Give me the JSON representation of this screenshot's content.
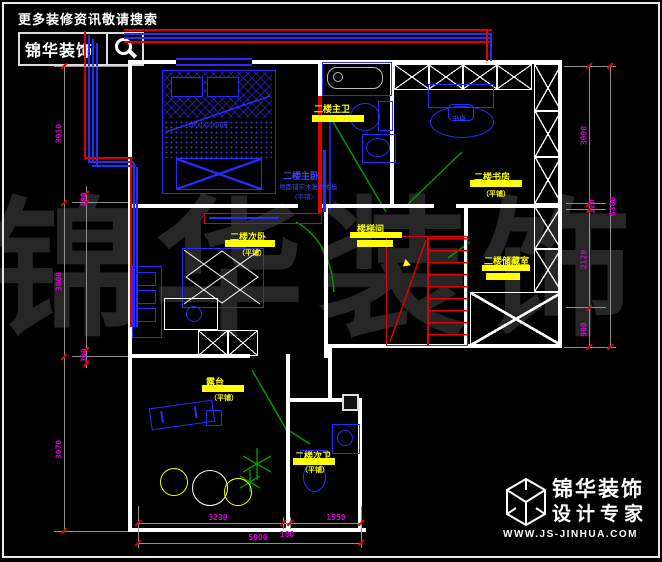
{
  "header": {
    "tagline": "更多装修资讯敬请搜索",
    "brand": "锦华装饰",
    "search_icon": "magnifier"
  },
  "watermark": "锦华装饰",
  "rooms": [
    {
      "name": "master-bedroom",
      "label": "二楼主卧",
      "note": "地面铺实木复合地板",
      "finish": "（平铺）"
    },
    {
      "name": "master-bath",
      "label": "二楼主卫",
      "finish": ""
    },
    {
      "name": "study",
      "label": "二楼书房",
      "finish": "（平铺）"
    },
    {
      "name": "second-bedroom",
      "label": "二楼次卧",
      "finish": "（平铺）"
    },
    {
      "name": "stairwell",
      "label": "楼梯间",
      "finish": ""
    },
    {
      "name": "storage",
      "label": "二楼储藏室",
      "finish": ""
    },
    {
      "name": "terrace",
      "label": "露台",
      "finish": "（平铺）"
    },
    {
      "name": "second-bath",
      "label": "二楼次卫",
      "finish": "（平铺）"
    }
  ],
  "annotations": {
    "bed": "1800X2000床",
    "desk": "书桌"
  },
  "dimensions": {
    "left_outer": [
      "3010",
      "3000",
      "3070"
    ],
    "left_inner": [
      "180",
      "300"
    ],
    "right_inner": [
      "3090",
      "2120",
      "900"
    ],
    "right_step": "120",
    "right_outer": "6300",
    "bottom_top_row": [
      "3230",
      "180",
      "1550"
    ],
    "bottom_total": "5000"
  },
  "brandmark": {
    "brand": "锦华装饰",
    "tagline": "设计专家",
    "url": "WWW.JS-JINHUA.COM",
    "logo": "cube-logo"
  },
  "colors": {
    "background": "#000000",
    "wall": "#ffffff",
    "furniture_blue": "#2a2aff",
    "pipe_red": "#e00000",
    "door_green": "#009900",
    "highlight_yellow": "#ffff00",
    "dimension_text": "#d400d4",
    "dimension_line": "#8f8f8f",
    "watermark": "#262626"
  }
}
